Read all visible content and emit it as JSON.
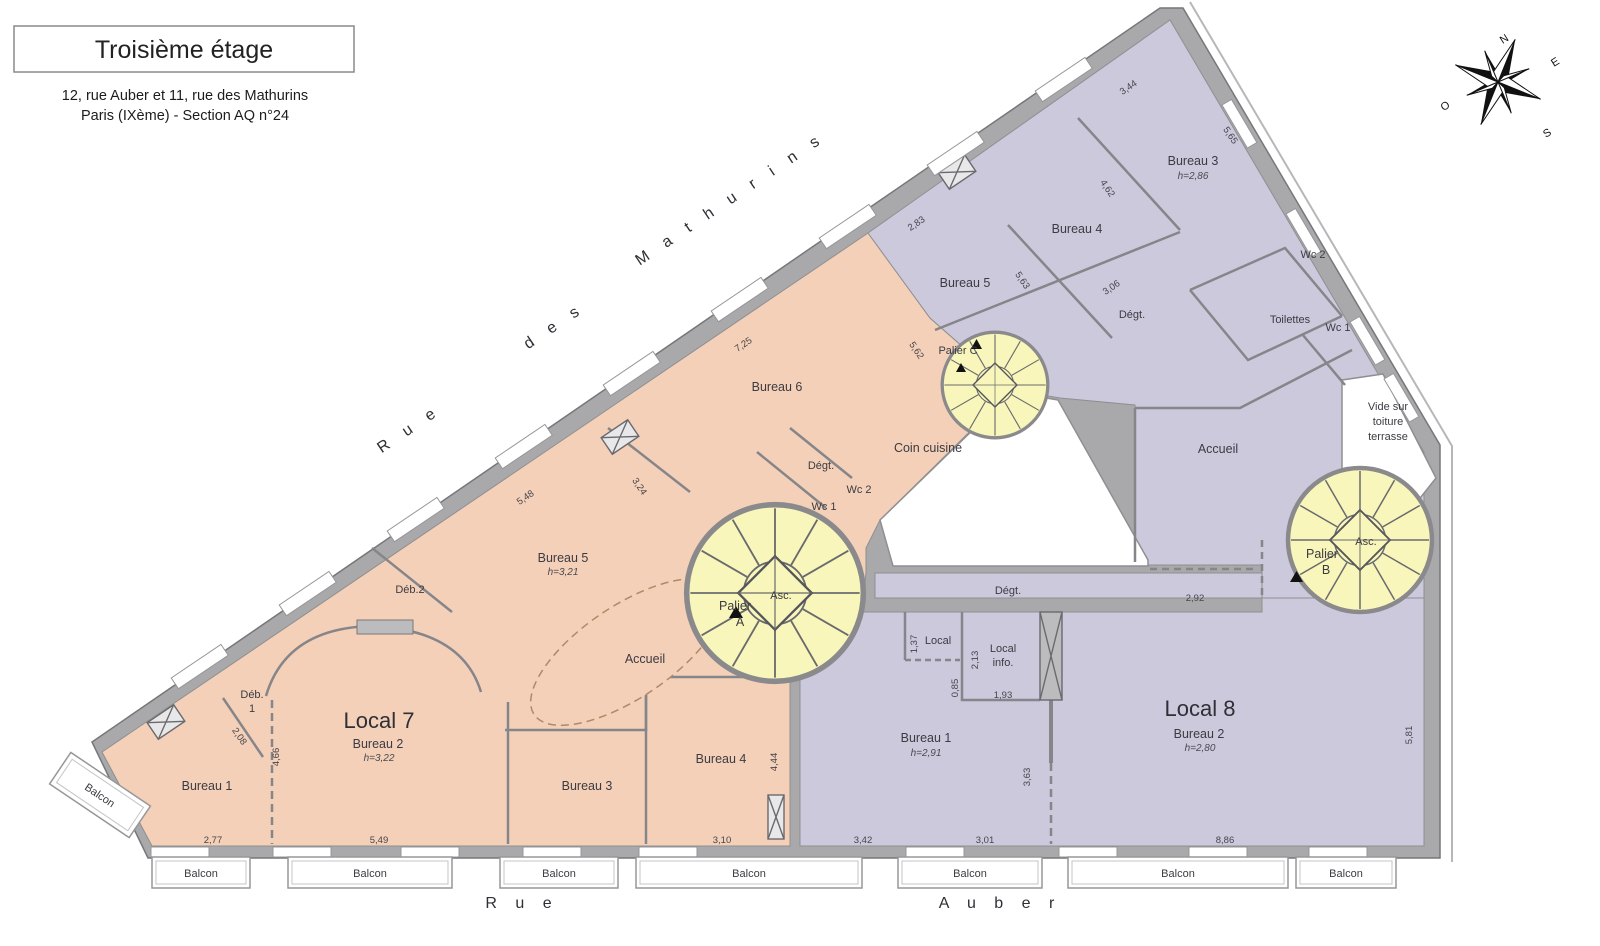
{
  "title_block": {
    "title": "Troisième étage",
    "address1": "12, rue Auber et 11, rue des Mathurins",
    "address2": "Paris (IXème) - Section AQ n°24"
  },
  "compass": {
    "n": "N",
    "e": "E",
    "s": "S",
    "o": "O"
  },
  "streets": {
    "rue_top": "R u e",
    "des": "d e s",
    "mathurins": "M a t h u r i n s",
    "rue_bottom": "R u e",
    "auber": "A u b e r"
  },
  "labels": {
    "balcon": "Balcon",
    "asc": "Asc.",
    "vide1": "Vide sur",
    "vide2": "toiture",
    "vide3": "terrasse"
  },
  "paliers": {
    "a1": "Palier",
    "a2": "A",
    "b1": "Palier",
    "b2": "B",
    "c": "Palier C"
  },
  "local7": {
    "name": "Local 7",
    "bureau1": "Bureau 1",
    "bureau2": "Bureau 2",
    "bureau2_h": "h=3,22",
    "bureau3": "Bureau 3",
    "bureau4": "Bureau 4",
    "bureau5": "Bureau 5",
    "bureau5_h": "h=3,21",
    "bureau6": "Bureau 6",
    "accueil": "Accueil",
    "coin_cuisine": "Coin cuisine",
    "degt": "Dégt.",
    "wc1": "Wc 1",
    "wc2": "Wc 2",
    "deb1a": "Déb.",
    "deb1b": "1",
    "deb2": "Déb.2"
  },
  "local8": {
    "name": "Local 8",
    "bureau1": "Bureau 1",
    "bureau1_h": "h=2,91",
    "bureau2": "Bureau 2",
    "bureau2_h": "h=2,80",
    "bureau3": "Bureau 3",
    "bureau3_h": "h=2,86",
    "bureau4": "Bureau 4",
    "bureau5": "Bureau 5",
    "degt_top": "Dégt.",
    "degt_corridor": "Dégt.",
    "toilettes": "Toilettes",
    "wc1": "Wc 1",
    "wc2": "Wc 2",
    "accueil": "Accueil",
    "local": "Local",
    "local_info1": "Local",
    "local_info2": "info."
  },
  "dims": {
    "d277": "2,77",
    "d549": "5,49",
    "d310": "3,10",
    "d342": "3,42",
    "d301": "3,01",
    "d886": "8,86",
    "d581": "5,81",
    "d444": "4,44",
    "d466": "4,66",
    "d208": "2,08",
    "d292": "2,92",
    "d137": "1,37",
    "d213": "2,13",
    "d085": "0,85",
    "d193": "1,93",
    "d363": "3,63",
    "d725": "7,25",
    "d562": "5,62",
    "d548": "5,48",
    "d324": "3,24",
    "d283": "2,83",
    "d563": "5,63",
    "d306": "3,06",
    "d344": "3,44",
    "d462": "4,62",
    "d565": "5,65"
  },
  "colors": {
    "local7_fill": "#f4d0b8",
    "local8_fill": "#ccc9dc",
    "stair_fill": "#f8f6ba",
    "wall_gray": "#a9a9ab"
  }
}
